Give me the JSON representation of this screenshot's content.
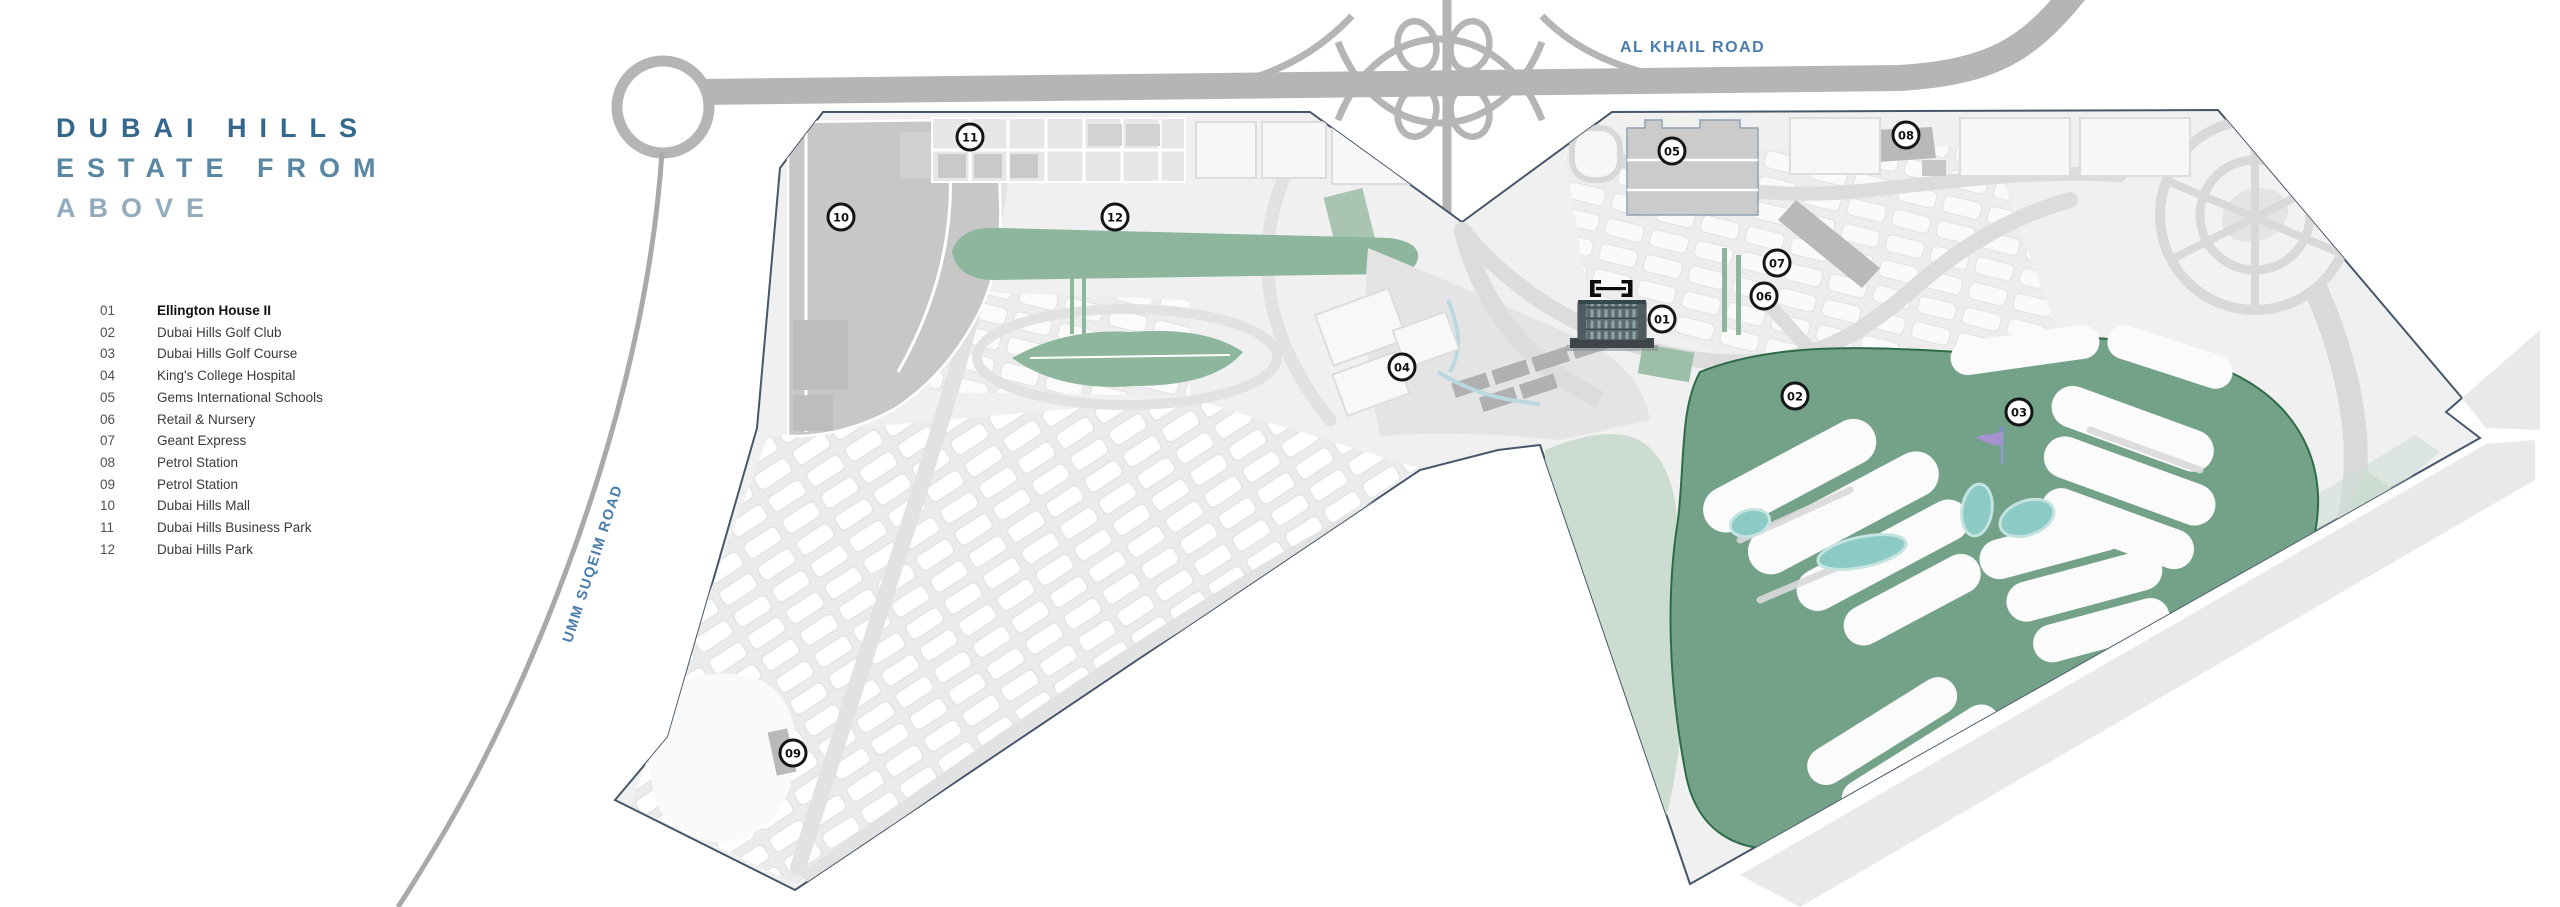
{
  "title": {
    "line1": "DUBAI HILLS",
    "line2": "ESTATE FROM",
    "line3": "ABOVE"
  },
  "legend": {
    "items": [
      {
        "num": "01",
        "label": "Ellington House II",
        "bold": true
      },
      {
        "num": "02",
        "label": "Dubai Hills Golf Club",
        "bold": false
      },
      {
        "num": "03",
        "label": "Dubai Hills Golf Course",
        "bold": false
      },
      {
        "num": "04",
        "label": "King's College Hospital",
        "bold": false
      },
      {
        "num": "05",
        "label": "Gems International Schools",
        "bold": false
      },
      {
        "num": "06",
        "label": "Retail & Nursery",
        "bold": false
      },
      {
        "num": "07",
        "label": "Geant Express",
        "bold": false
      },
      {
        "num": "08",
        "label": "Petrol Station",
        "bold": false
      },
      {
        "num": "09",
        "label": "Petrol Station",
        "bold": false
      },
      {
        "num": "10",
        "label": "Dubai Hills Mall",
        "bold": false
      },
      {
        "num": "11",
        "label": "Dubai Hills Business Park",
        "bold": false
      },
      {
        "num": "12",
        "label": "Dubai Hills Park",
        "bold": false
      }
    ]
  },
  "map": {
    "road_labels": {
      "al_khail": "AL KHAIL ROAD",
      "umm_suqeim": "UMM SUQEIM ROAD"
    },
    "markers": [
      {
        "num": "01",
        "x": 1662,
        "y": 319
      },
      {
        "num": "02",
        "x": 1795,
        "y": 396
      },
      {
        "num": "03",
        "x": 2019,
        "y": 412
      },
      {
        "num": "04",
        "x": 1402,
        "y": 367
      },
      {
        "num": "05",
        "x": 1672,
        "y": 151
      },
      {
        "num": "06",
        "x": 1764,
        "y": 296
      },
      {
        "num": "07",
        "x": 1777,
        "y": 263
      },
      {
        "num": "08",
        "x": 1906,
        "y": 135
      },
      {
        "num": "09",
        "x": 793,
        "y": 753
      },
      {
        "num": "10",
        "x": 841,
        "y": 217
      },
      {
        "num": "11",
        "x": 970,
        "y": 137
      },
      {
        "num": "12",
        "x": 1115,
        "y": 217
      }
    ]
  },
  "colors": {
    "title_line1": "#33678c",
    "title_line2": "#5a87a4",
    "title_line3": "#93acbd",
    "road_label": "#4a7cab",
    "boundary": "#47576b",
    "highway": "#b5b5b5",
    "estate_fill": "#f0f0f1",
    "golf_green": "#73a288",
    "golf_edge": "#2e6b47",
    "park_green": "#8db69c",
    "pale_green": "#ccdcd1",
    "water": "#8ccac6",
    "marker_border": "#151515"
  }
}
